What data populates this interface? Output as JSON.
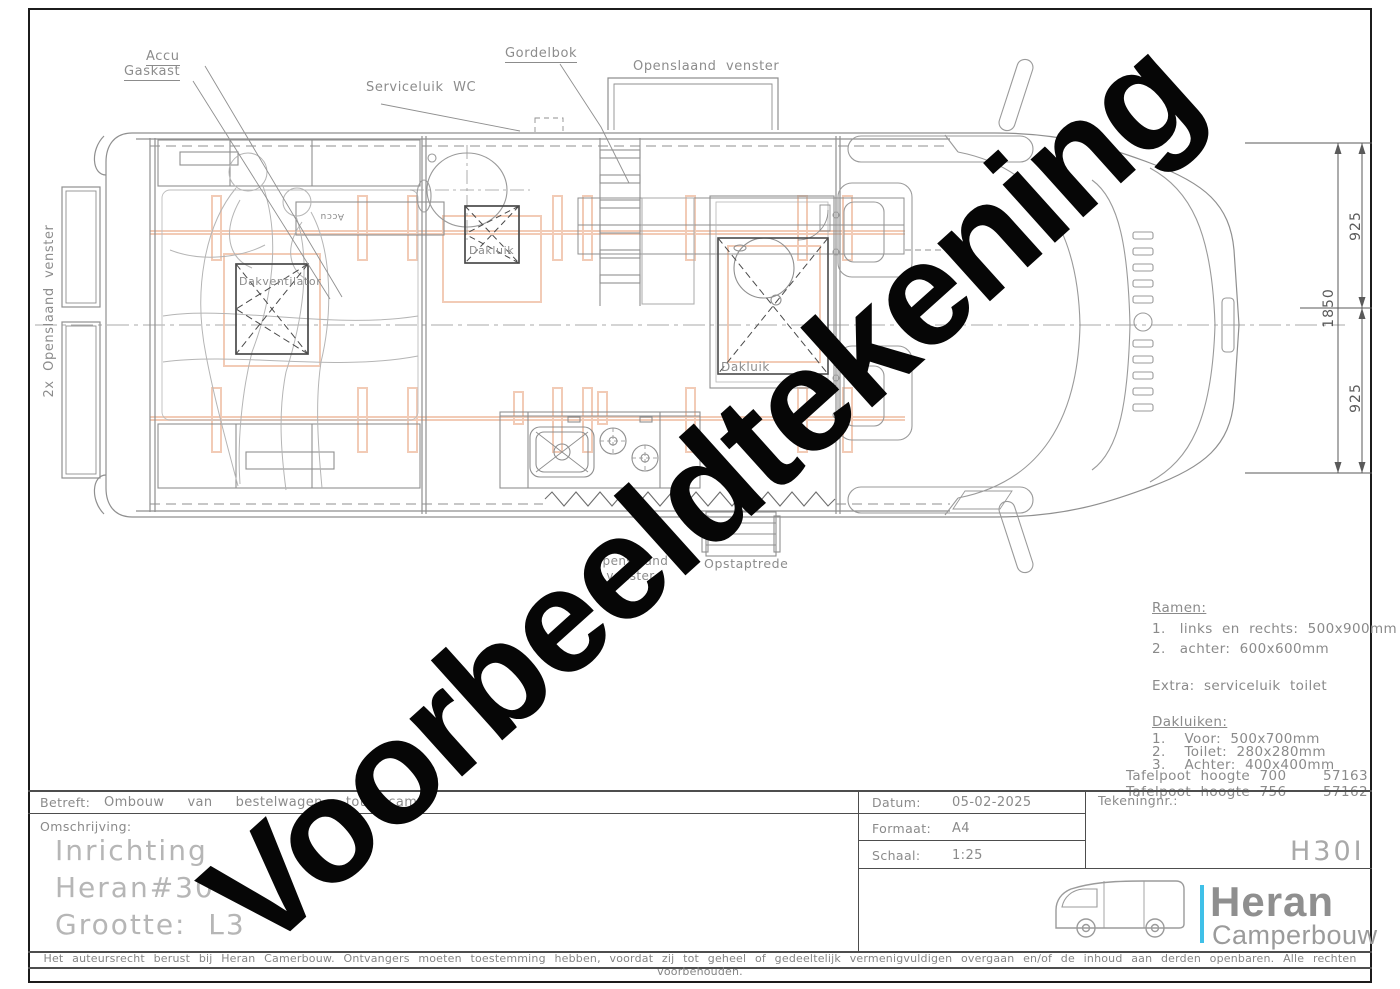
{
  "watermark": "Voorbeeldtekening",
  "drawing": {
    "labels": {
      "accu": "Accu",
      "gaskast": "Gaskast",
      "serviceluik_wc": "Serviceluik  WC",
      "gordelbok": "Gordelbok",
      "openslaand_venster_top": "Openslaand  venster",
      "openslaand_venster_left": "2x  Openslaand  venster",
      "openslaand_venster_bottom": "Openslaand venster",
      "dakluik_voor": "Dakluik",
      "dakluik_toilet": "Dakluik",
      "dakventilator": "Dakventilator",
      "accu_klein": "Accu",
      "opstaptrede": "Opstaptrede"
    },
    "dimensions": {
      "voor": "925",
      "totaal": "1850",
      "achter": "925"
    }
  },
  "notes": {
    "ramen_title": "Ramen:",
    "ramen_1": "1.   links  en  rechts:  500x900mm",
    "ramen_2": "2.   achter:  600x600mm",
    "ramen_extra": "Extra:  serviceluik  toilet",
    "dakluiken_title": "Dakluiken:",
    "dakluiken_1": "1.    Voor:  500x700mm",
    "dakluiken_2": "2.    Toilet:  280x280mm",
    "dakluiken_3": "3.    Achter:  400x400mm",
    "tafelpoot_1_label": "Tafelpoot  hoogte  700",
    "tafelpoot_1_code": "57163",
    "tafelpoot_2_label": "Tafelpoot  hoogte  756",
    "tafelpoot_2_code": "57162"
  },
  "title_block": {
    "betreft_label": "Betreft:",
    "betreft_value": "Ombouw  van  bestelwagen  tot  cam",
    "omschrijving_label": "Omschrijving:",
    "omschrijving_line1": "Inrichting",
    "omschrijving_line2": "Heran#30",
    "omschrijving_line3": "Grootte:  L3",
    "datum_label": "Datum:",
    "datum_value": "05-02-2025",
    "formaat_label": "Formaat:",
    "formaat_value": "A4",
    "schaal_label": "Schaal:",
    "schaal_value": "1:25",
    "tekeningnr_label": "Tekeningnr.:",
    "tekeningnr_value": "H30I"
  },
  "logo": {
    "brand": "Heran",
    "subtitle": "Camperbouw",
    "accent_color": "#3fc0e8"
  },
  "footer": {
    "copyright": "Het auteursrecht berust bij Heran Camerbouw. Ontvangers moeten toestemming hebben, voordat zij tot geheel of gedeeltelijk vermenigvuldigen overgaan en/of de inhoud aan derden openbaren. Alle rechten voorbehouden."
  }
}
